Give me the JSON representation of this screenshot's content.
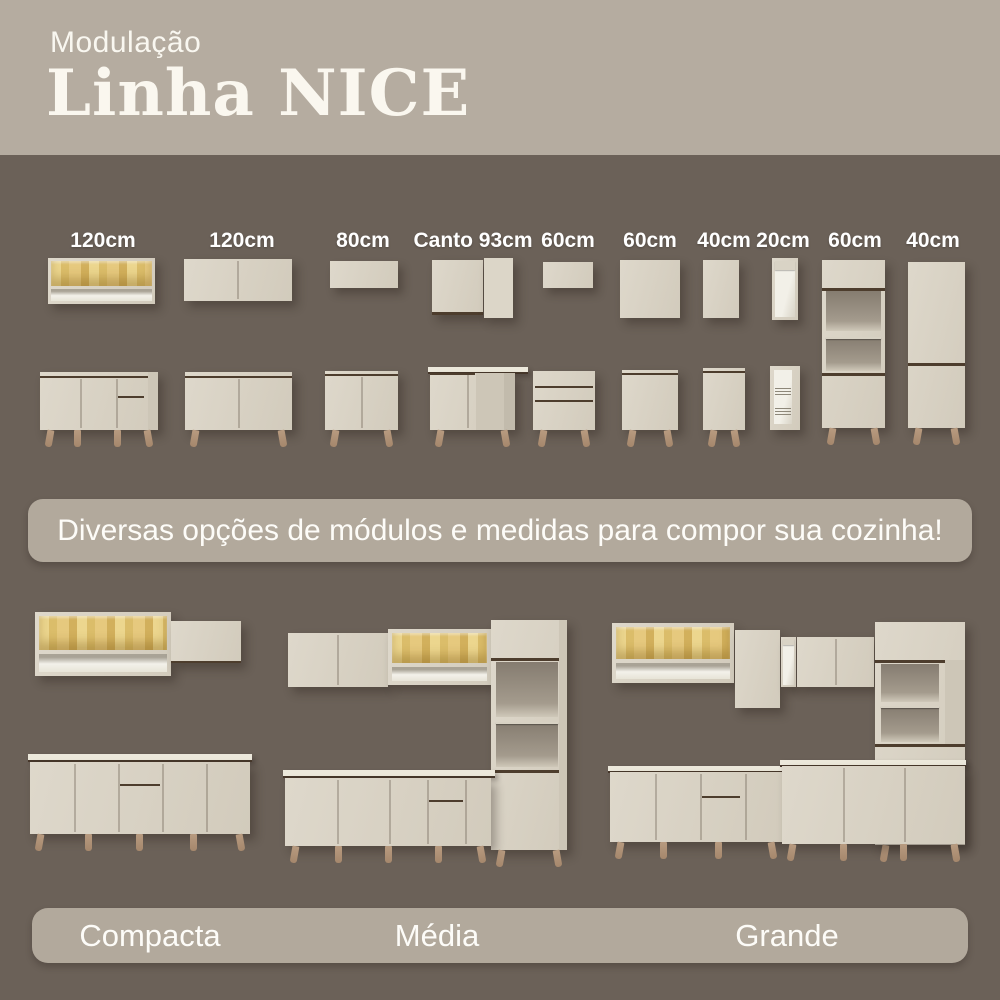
{
  "header": {
    "kicker": "Modulação",
    "title": "Linha NICE"
  },
  "modules": {
    "labels": [
      "120cm",
      "120cm",
      "80cm",
      "Canto 93cm",
      "60cm",
      "60cm",
      "40cm",
      "20cm",
      "60cm",
      "40cm"
    ]
  },
  "banner": {
    "text": "Diversas opções de módulos e medidas para compor sua cozinha!"
  },
  "kitchens": {
    "labels": [
      "Compacta",
      "Média",
      "Grande"
    ]
  },
  "palette": {
    "header_bg": "#b5aca0",
    "body_bg": "#6b6158",
    "pill_bg": "#b2a99c",
    "cabinet_cream": "#d9d2c4",
    "glass_amber": "#e0c172",
    "leg_wood": "#b2947a",
    "trim_dark": "#4d3d2d",
    "text_light": "#fbfaf5"
  }
}
